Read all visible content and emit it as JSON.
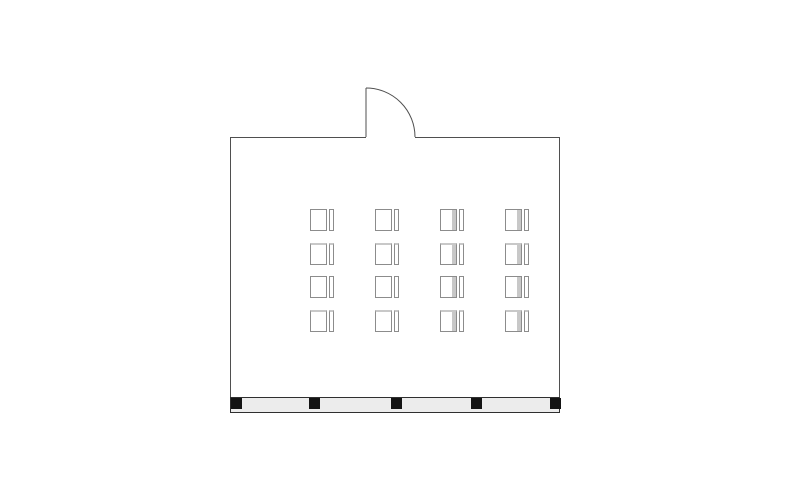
{
  "page": {
    "background": "#ffffff",
    "kind": "room-floor-plan"
  },
  "floorplan": {
    "description": "classroom-style seating floor plan",
    "wall_color": "#4f4f4f",
    "room": {
      "x": 230,
      "y": 137,
      "width": 330,
      "height": 276
    },
    "door": {
      "opening_from_x": 366,
      "opening_to_x": 415,
      "hinge_x": 366,
      "hinge_y": 137,
      "leaf_top_y": 88,
      "radius": 49,
      "swing": "outward"
    },
    "desk_grid": {
      "rows": 4,
      "cols": 4,
      "origin_x": 310,
      "origin_y": 209,
      "col_spacing": 65,
      "row_spacing": 33.6,
      "desk_width": 17,
      "desk_height": 22,
      "chair_width": 5,
      "chair_height": 22,
      "chair_gap": 2,
      "outline_color": "#8c8c8c",
      "accent_color": "#c8c8c8",
      "accent_top_rows": [
        1,
        3
      ],
      "accent_side_cols": [
        2,
        3
      ]
    },
    "window_wall": {
      "x": 230,
      "y": 397,
      "width": 330,
      "height": 16,
      "fill": "#ececec",
      "border_color": "#2f2f2f",
      "posts": {
        "count": 5,
        "size": 11,
        "color": "#141414",
        "offsets": [
          0,
          78,
          160,
          240,
          319
        ]
      }
    }
  }
}
